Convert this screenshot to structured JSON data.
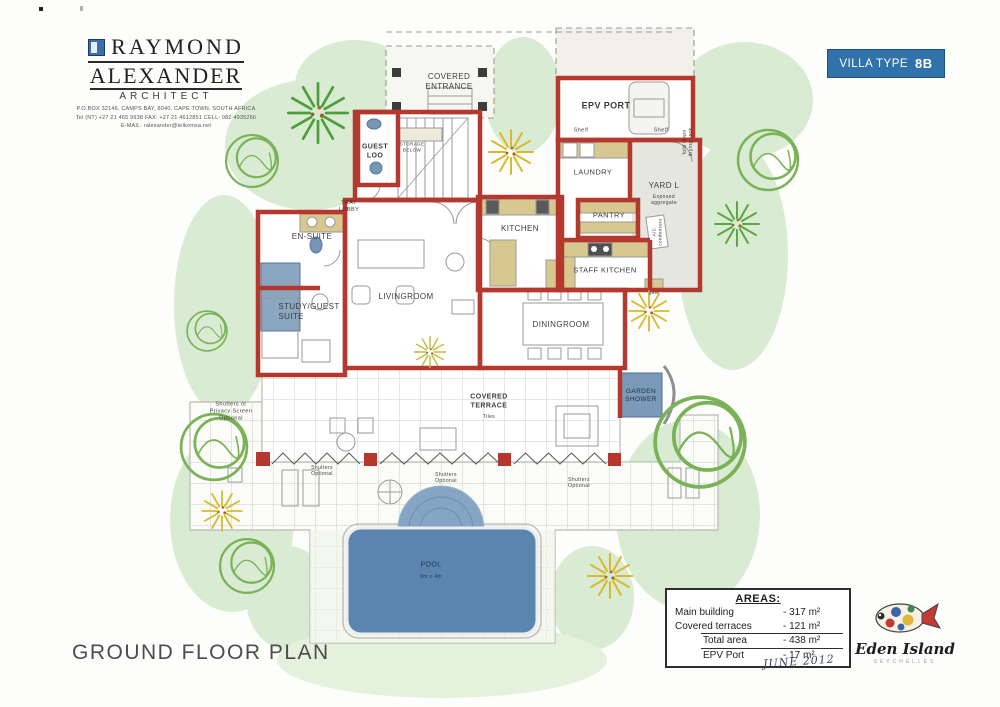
{
  "brand": {
    "name_line1": "RAYMOND",
    "name_line2": "ALEXANDER",
    "role": "ARCHITECT",
    "address": "P.O.BOX 32146, CAMPS BAY, 8040, CAPE TOWN, SOUTH AFRICA",
    "phones": "Tel  (NT) +27 21 465 9938   FAX: +27 21 4612851   CELL: 082 4935266",
    "email": "E-MAIL:  ralexander@telkomsa.net"
  },
  "badge": {
    "label": "VILLA TYPE",
    "value": "8B"
  },
  "plan_title": "GROUND FLOOR PLAN",
  "date": "JUNE 2012",
  "areas": {
    "heading": "AREAS:",
    "rows": [
      {
        "label": "Main building",
        "value": "- 317 m²"
      },
      {
        "label": "Covered terraces",
        "value": "- 121 m²"
      },
      {
        "label": "Total area",
        "value": "- 438 m²"
      },
      {
        "label": "EPV Port",
        "value": "- 17 m²"
      }
    ]
  },
  "developer_logo": {
    "name": "Eden Island",
    "tagline": "SEYCHELLES"
  },
  "plan_labels": {
    "covered_entrance": "COVERED\nENTRANCE",
    "epv_port": "EPV PORT",
    "shelf": "Shelf",
    "guest_loo": "GUEST\nLOO",
    "storage_below": "STORAGE\nBELOW",
    "drying_rack": "fold down\ndrying rack",
    "laundry": "LAUNDRY",
    "yard": "YARD L",
    "yard_note": "Exposed\naggregate",
    "tray_lobby": "TRAY\nLOBBY",
    "pantry": "PANTRY",
    "kitchen": "KITCHEN",
    "staff_kitchen": "STAFF KITCHEN",
    "ac_condensers": "A/C\ncondensers",
    "gate": "gate",
    "en_suite": "EN-SUITE",
    "study_guest_suite": "STUDY/GUEST\nSUITE",
    "livingroom": "LIVINGROOM",
    "diningroom": "DININGROOM",
    "garden_shower": "GARDEN\nSHOWER",
    "covered_terrace": "COVERED\nTERRACE",
    "tiles": "Tiles",
    "shutters_privacy": "Shutters or\nPrivacy Screen\nOptional",
    "shutters_optional": "Shutters\nOptional",
    "pool": "POOL",
    "pool_size": "9m x 4m"
  },
  "colors": {
    "wall_red": "#b5382f",
    "badge_blue": "#3072a9",
    "pool_blue": "#5b85ae",
    "landscape_green": "#d9ebd2"
  }
}
